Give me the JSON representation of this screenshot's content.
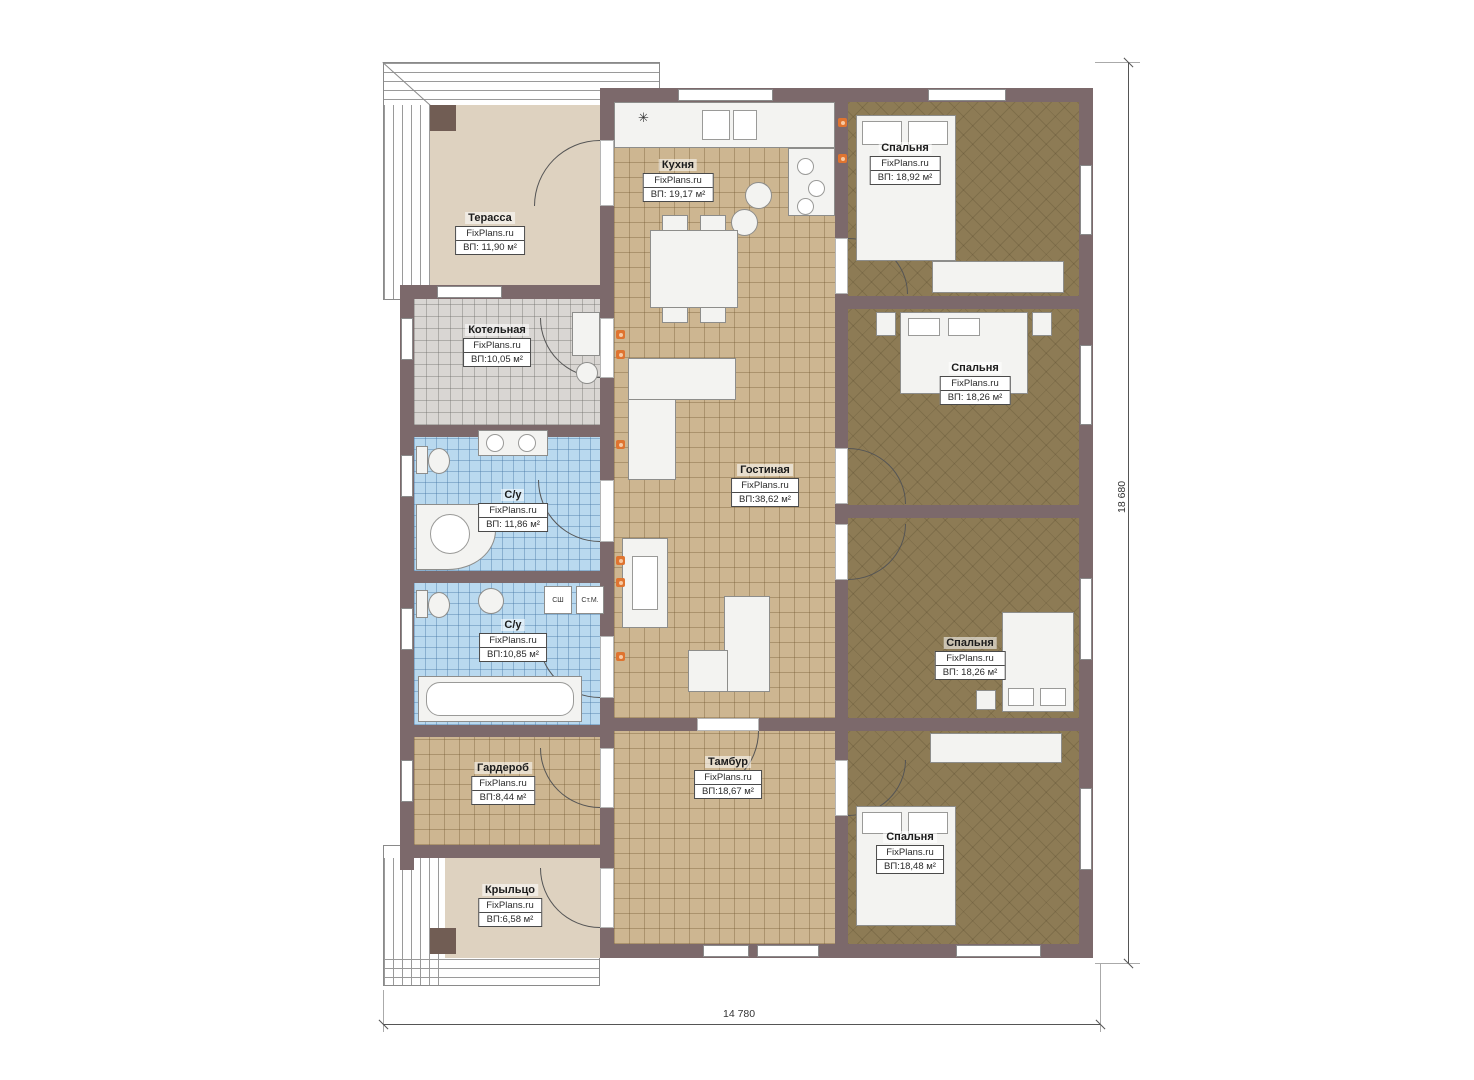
{
  "brand": "FixPlans.ru",
  "rooms": [
    {
      "id": "terrace",
      "name": "Терасса",
      "area": "ВП: 11,90 м²"
    },
    {
      "id": "kitchen",
      "name": "Кухня",
      "area": "ВП: 19,17 м²"
    },
    {
      "id": "bedroom1",
      "name": "Спальня",
      "area": "ВП: 18,92 м²"
    },
    {
      "id": "boiler",
      "name": "Котельная",
      "area": "ВП:10,05 м²"
    },
    {
      "id": "bath1",
      "name": "С/у",
      "area": "ВП: 11,86 м²"
    },
    {
      "id": "living",
      "name": "Гостиная",
      "area": "ВП:38,62 м²"
    },
    {
      "id": "bedroom2",
      "name": "Спальня",
      "area": "ВП: 18,26 м²"
    },
    {
      "id": "bath2",
      "name": "С/у",
      "area": "ВП:10,85 м²"
    },
    {
      "id": "bedroom3",
      "name": "Спальня",
      "area": "ВП: 18,26 м²"
    },
    {
      "id": "wardrobe",
      "name": "Гардероб",
      "area": "ВП:8,44 м²"
    },
    {
      "id": "tambour",
      "name": "Тамбур",
      "area": "ВП:18,67 м²"
    },
    {
      "id": "bedroom4",
      "name": "Спальня",
      "area": "ВП:18,48 м²"
    },
    {
      "id": "porch",
      "name": "Крыльцо",
      "area": "ВП:6,58 м²"
    }
  ],
  "appliances": {
    "dryer": "СШ",
    "washer": "Ст.М."
  },
  "dimensions": {
    "height": "18 680",
    "width": "14 780"
  },
  "icons": {
    "vent": "✳"
  },
  "colors": {
    "wall": "#7c696b",
    "floor_tan": "#cdb691",
    "floor_bedroom": "#8d7b55",
    "floor_bath": "#b9d9ef",
    "floor_boiler": "#d9d6d3",
    "floor_terrace": "#ded2c0",
    "outlet_accent": "#df7430"
  }
}
